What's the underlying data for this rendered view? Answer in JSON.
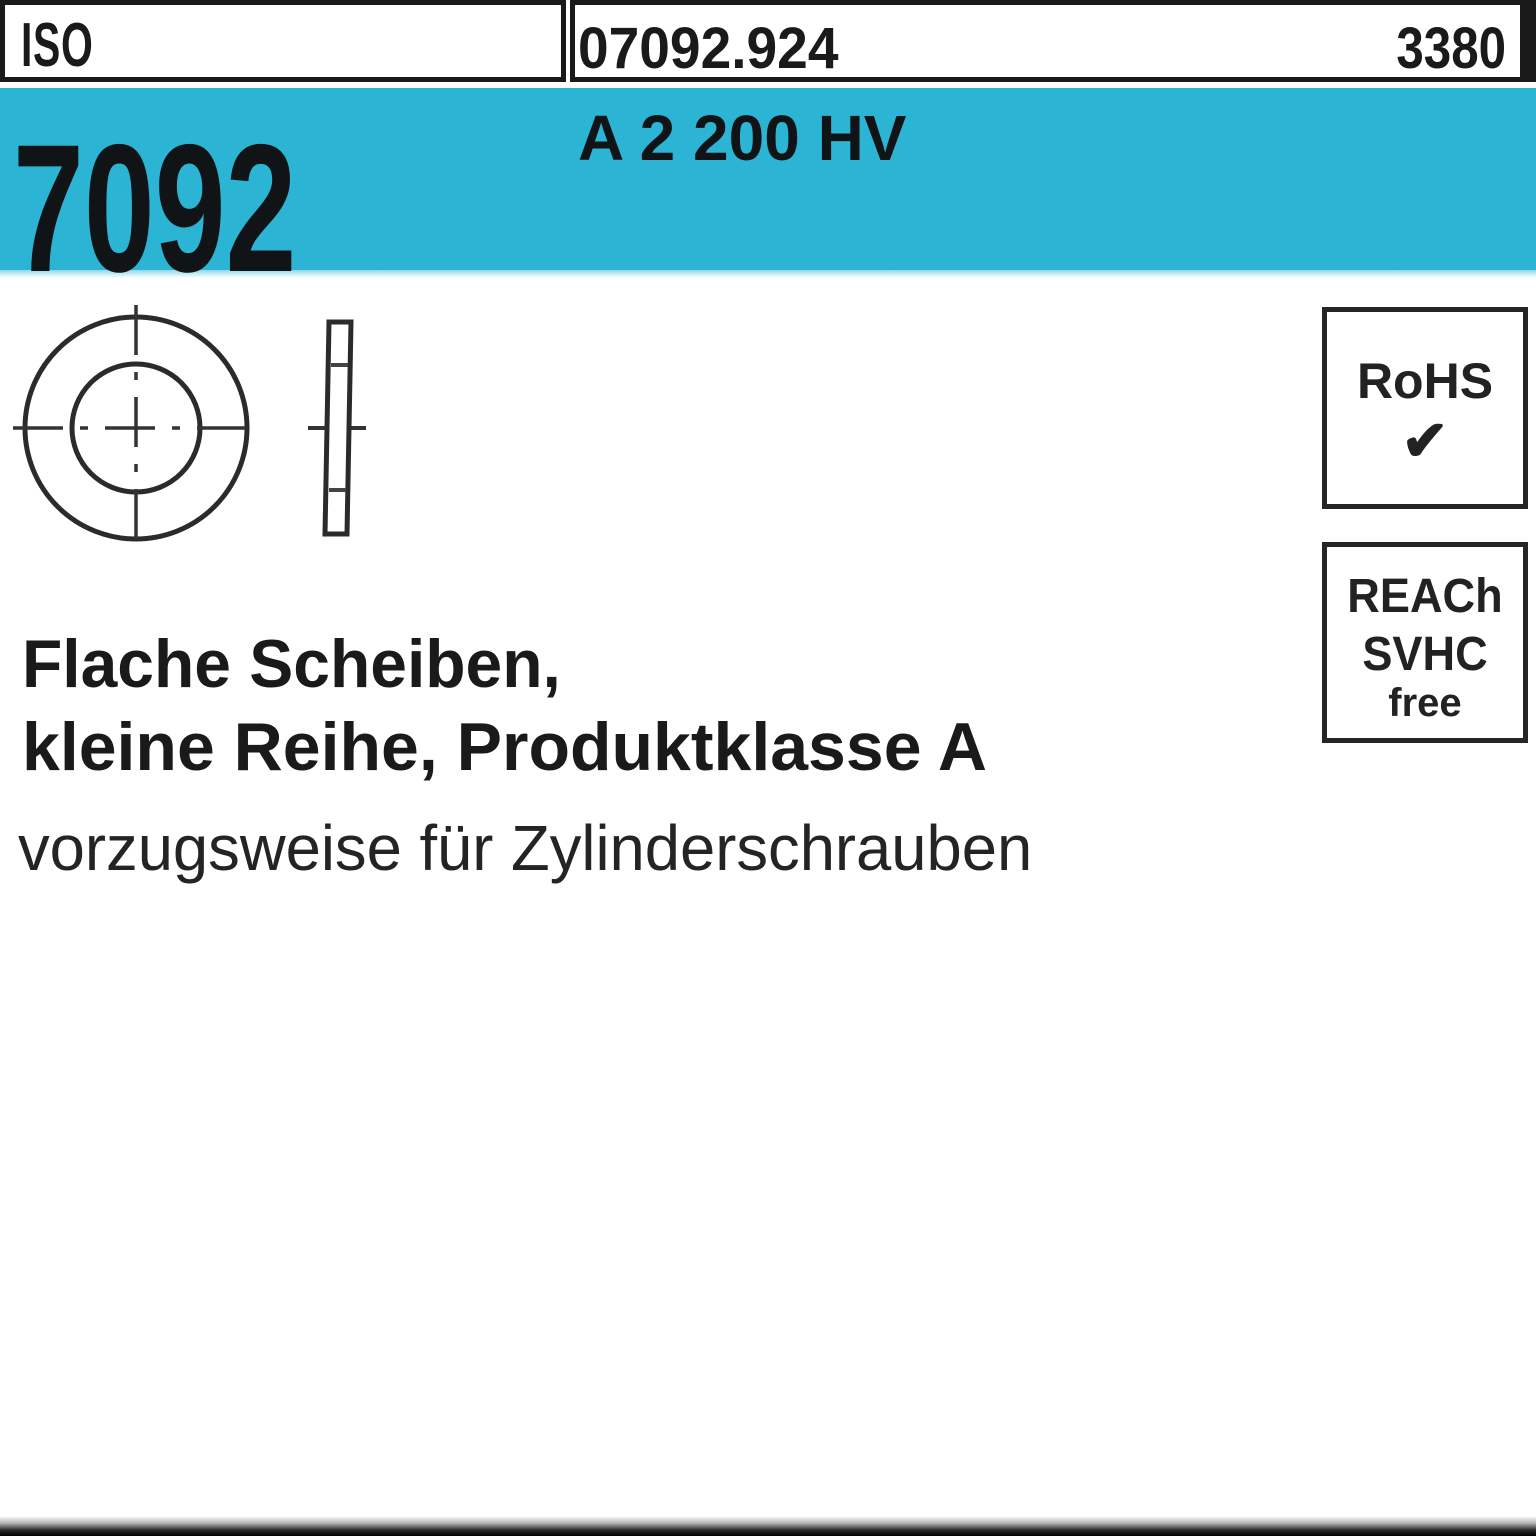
{
  "theme": {
    "cyan": "#2cb4d4",
    "ink": "#1a1a1a",
    "line": "#2b2b2b",
    "paper": "#ffffff"
  },
  "header": {
    "standard_org": "ISO",
    "article_number": "07092.924",
    "catalog_page": "3380"
  },
  "banner": {
    "norm_number": "7092",
    "material_grade": "A 2 200 HV"
  },
  "badges": {
    "rohs": {
      "label": "RoHS",
      "check_glyph": "✔"
    },
    "reach": {
      "line1": "REACh",
      "line2": "SVHC",
      "line3": "free"
    }
  },
  "description": {
    "line1": "Flache Scheiben,",
    "line2": "kleine Reihe, Produktklasse A",
    "line3": "vorzugsweise für Zylinderschrauben"
  }
}
